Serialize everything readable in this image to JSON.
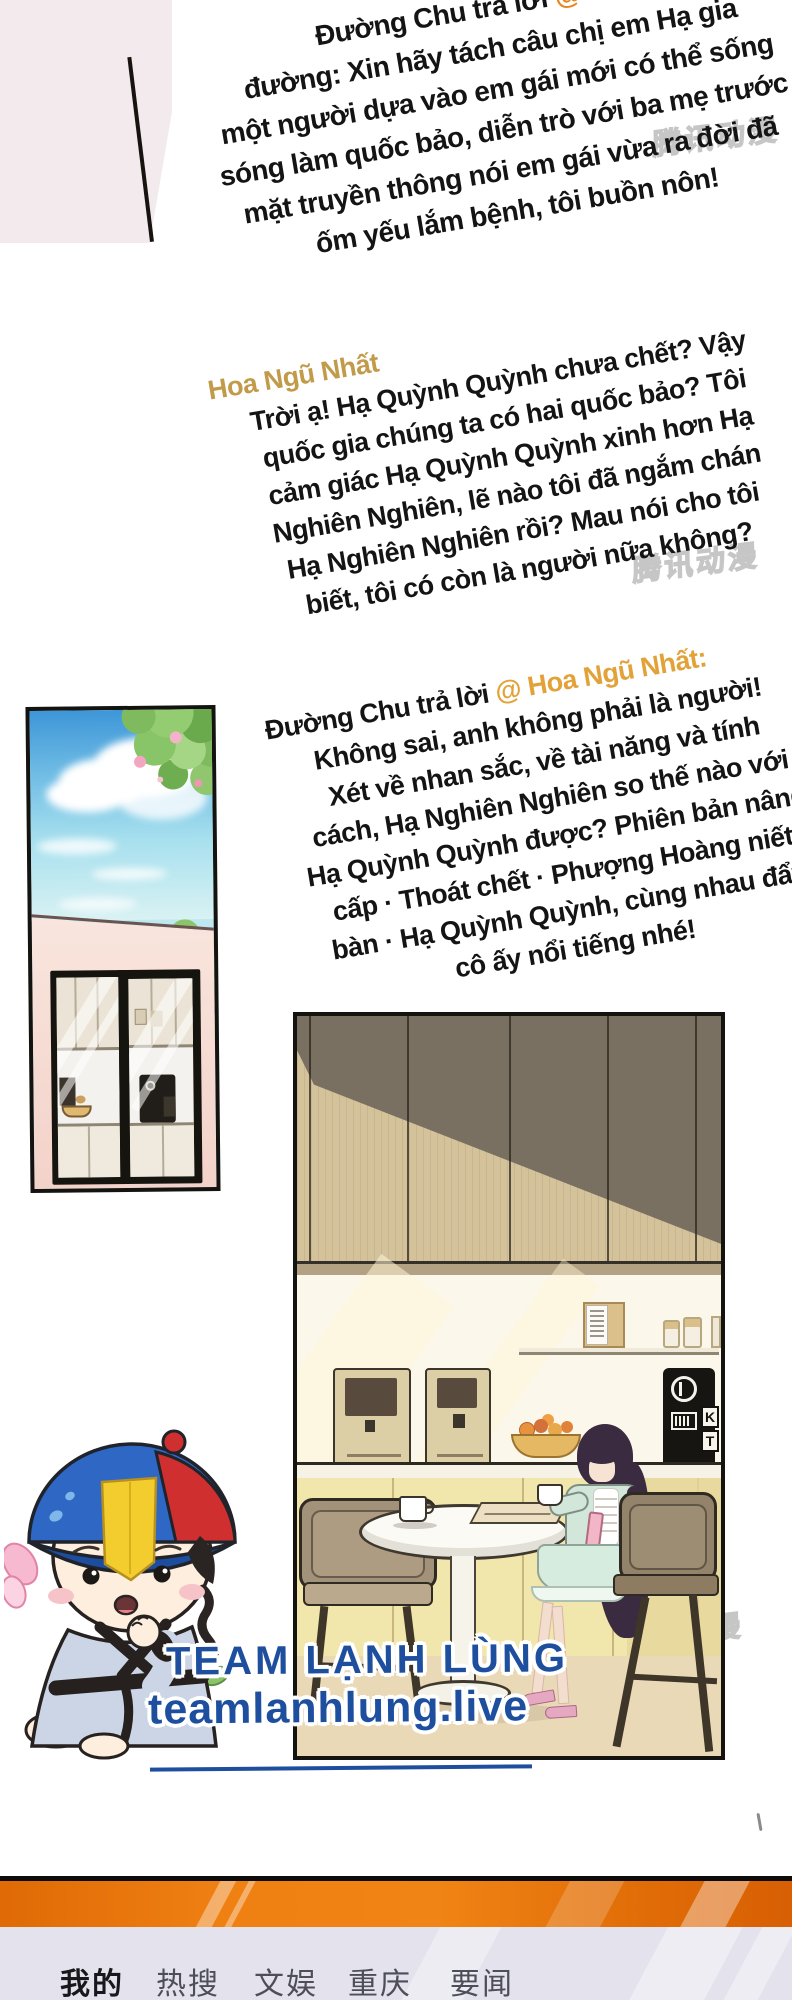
{
  "comments": {
    "c1": {
      "prefix": "Đường Chu trả lời ",
      "mention": "@ Tôi g",
      "body": [
        "đường: Xin hãy tách câu chị em Hạ gia",
        "một người dựa vào em gái mới có thể sống",
        "sóng làm quốc bảo, diễn trò với ba mẹ trước",
        "mặt truyền thông nói em gái vừa ra đời đã",
        "ốm yếu lắm bệnh, tôi buồn nôn!"
      ]
    },
    "c2": {
      "username": "Hoa Ngũ Nhất",
      "body": [
        "Trời ạ! Hạ Quỳnh Quỳnh chưa chết? Vậy",
        "quốc gia chúng ta có hai quốc bảo? Tôi",
        "cảm giác Hạ Quỳnh Quỳnh xinh hơn Hạ",
        "Nghiên Nghiên, lẽ nào tôi đã ngắm chán",
        "Hạ Nghiên Nghiên rồi? Mau nói cho tôi",
        "biết, tôi có còn là người nữa không?"
      ]
    },
    "c3": {
      "prefix": "Đường Chu trả lời ",
      "mention": "@ Hoa Ngũ Nhất:",
      "body": [
        "Không sai, anh không phải là người!",
        "Xét về nhan sắc, về tài năng và tính",
        "cách, Hạ Nghiên Nghiên so thế nào với",
        "Hạ Quỳnh Quỳnh được? Phiên bản nâng",
        "cấp · Thoát chết · Phượng Hoàng niết",
        "bàn · Hạ Quỳnh Quỳnh, cùng nhau đẩy",
        "cô ấy nổi tiếng nhé!"
      ]
    }
  },
  "watermark": {
    "text": "腾讯动漫"
  },
  "credits": {
    "team": "TEAM LẠNH LÙNG",
    "site": "teamlanhlung.live"
  },
  "machine_sign": {
    "top": "K",
    "bottom": "T"
  },
  "tabbar": {
    "tabs": [
      {
        "label": "我的",
        "active": true
      },
      {
        "label": "热搜",
        "active": false
      },
      {
        "label": "文娱",
        "active": false
      },
      {
        "label": "重庆",
        "active": false
      },
      {
        "label": "要闻",
        "active": false
      }
    ]
  },
  "colors": {
    "username_gold": "#c19a4a",
    "mention_orange": "#e2a238",
    "mention_orange_bright": "#e8871f",
    "team_blue": "#1e4f9e",
    "tabbar_orange": "#ef8012"
  }
}
